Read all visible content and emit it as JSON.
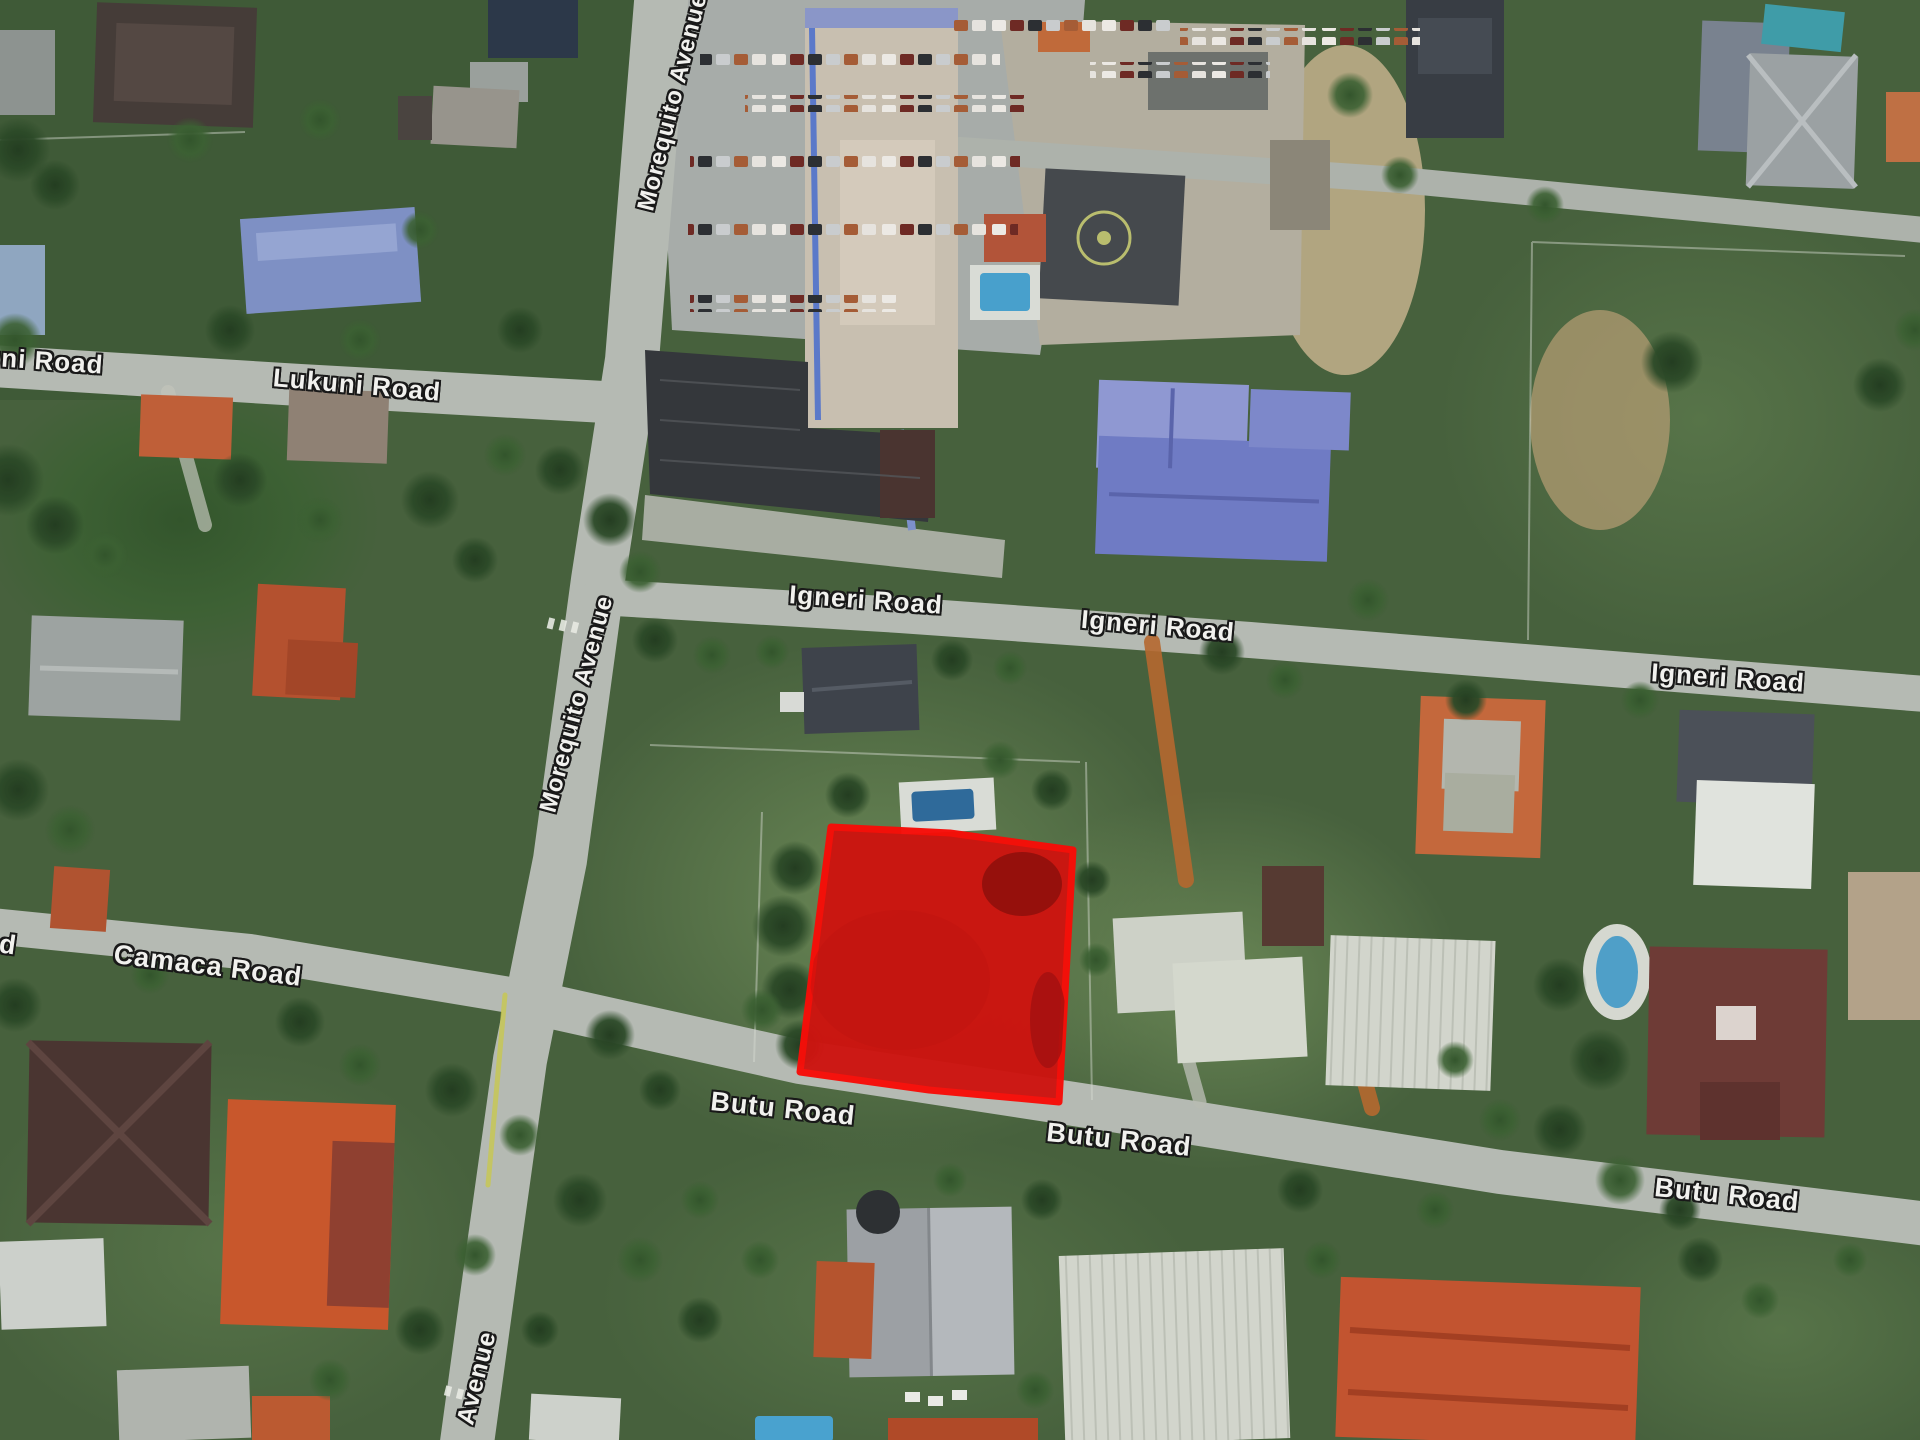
{
  "map": {
    "view": "satellite-aerial",
    "colors": {
      "label-text": "#f1f1ee",
      "label-outline": "#191919",
      "parcel-fill": "#cd1410",
      "parcel-stroke": "#f70d08"
    },
    "road_labels": [
      {
        "text": "uni Road"
      },
      {
        "text": "Lukuni Road"
      },
      {
        "text": "Morequito Avenue"
      },
      {
        "text": "Igneri Road"
      },
      {
        "text": "Igneri Road"
      },
      {
        "text": "Igneri Road"
      },
      {
        "text": "Morequito Avenue"
      },
      {
        "text": "Camaca Road"
      },
      {
        "text": "d"
      },
      {
        "text": "Butu Road"
      },
      {
        "text": "Butu Road"
      },
      {
        "text": "Butu Road"
      },
      {
        "text": "Avenue"
      }
    ],
    "parcel": {
      "points": "831,827 950,833 1073,850 1066,975 1059,1102 929,1090 800,1072 815,950",
      "fill": "#cd1410",
      "stroke": "#f70d08"
    }
  }
}
